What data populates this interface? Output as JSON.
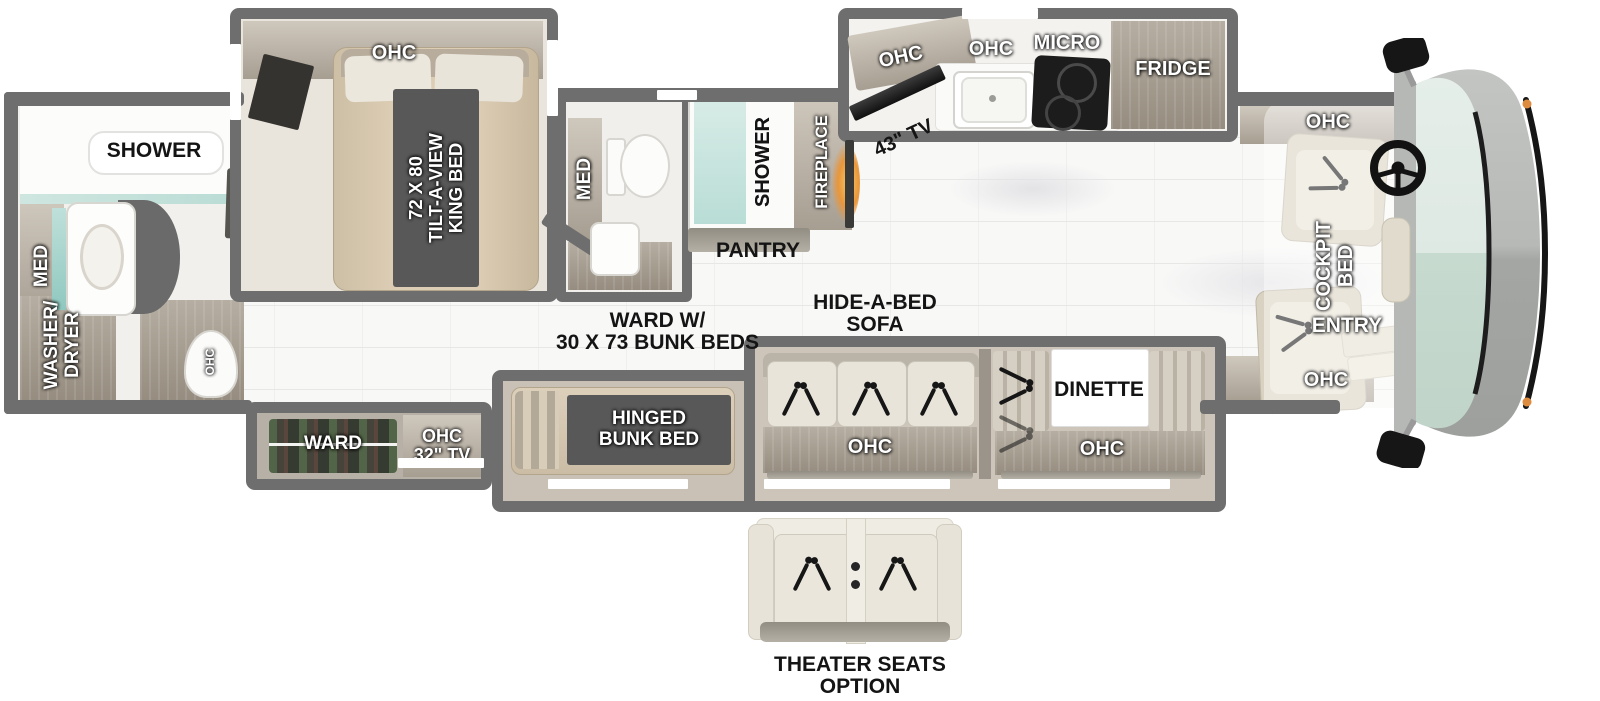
{
  "title": "Motorhome floor plan",
  "colors": {
    "wall": "#6e6e6e",
    "wood": "#b5ada1",
    "dark_label_box": "#585858",
    "bed_tan": "#d7c8b0",
    "upholstery": "#e8e4da",
    "shower_glass": "#cfe6e0",
    "fireplace_glow": "#e8963c",
    "windshield": "#dfe9e3",
    "cab_body": "#b0b2b0",
    "floor": "#f8f8f7"
  },
  "labels": {
    "rear_bathroom": {
      "shower": "SHOWER",
      "med": "MED",
      "washer_dryer": "WASHER/\nDRYER",
      "ohc": "OHC"
    },
    "bedroom": {
      "ohc": "OHC",
      "king_bed": "72 X 80\nTILT-A-VIEW\nKING BED"
    },
    "mid_bathroom": {
      "med": "MED"
    },
    "living": {
      "shower": "SHOWER",
      "fireplace": "FIREPLACE",
      "pantry": "PANTRY",
      "tv": "43\" TV",
      "hide_a_bed": "HIDE-A-BED\nSOFA",
      "sofa_ohc": "OHC",
      "dinette": "DINETTE",
      "dinette_ohc": "OHC"
    },
    "kitchen": {
      "ohc_left": "OHC",
      "ohc_center": "OHC",
      "micro": "MICRO",
      "fridge": "FRIDGE"
    },
    "bunk_area": {
      "ward": "WARD",
      "ohc_tv": "OHC\n32\" TV",
      "ward_bunks": "WARD W/\n30 X 73 BUNK BEDS",
      "hinged_bunk": "HINGED\nBUNK BED"
    },
    "cockpit": {
      "ohc_top": "OHC",
      "cockpit_bed": "COCKPIT\nBED",
      "entry": "ENTRY",
      "ohc_bottom": "OHC"
    },
    "theater": {
      "label": "THEATER SEATS\nOPTION"
    }
  }
}
